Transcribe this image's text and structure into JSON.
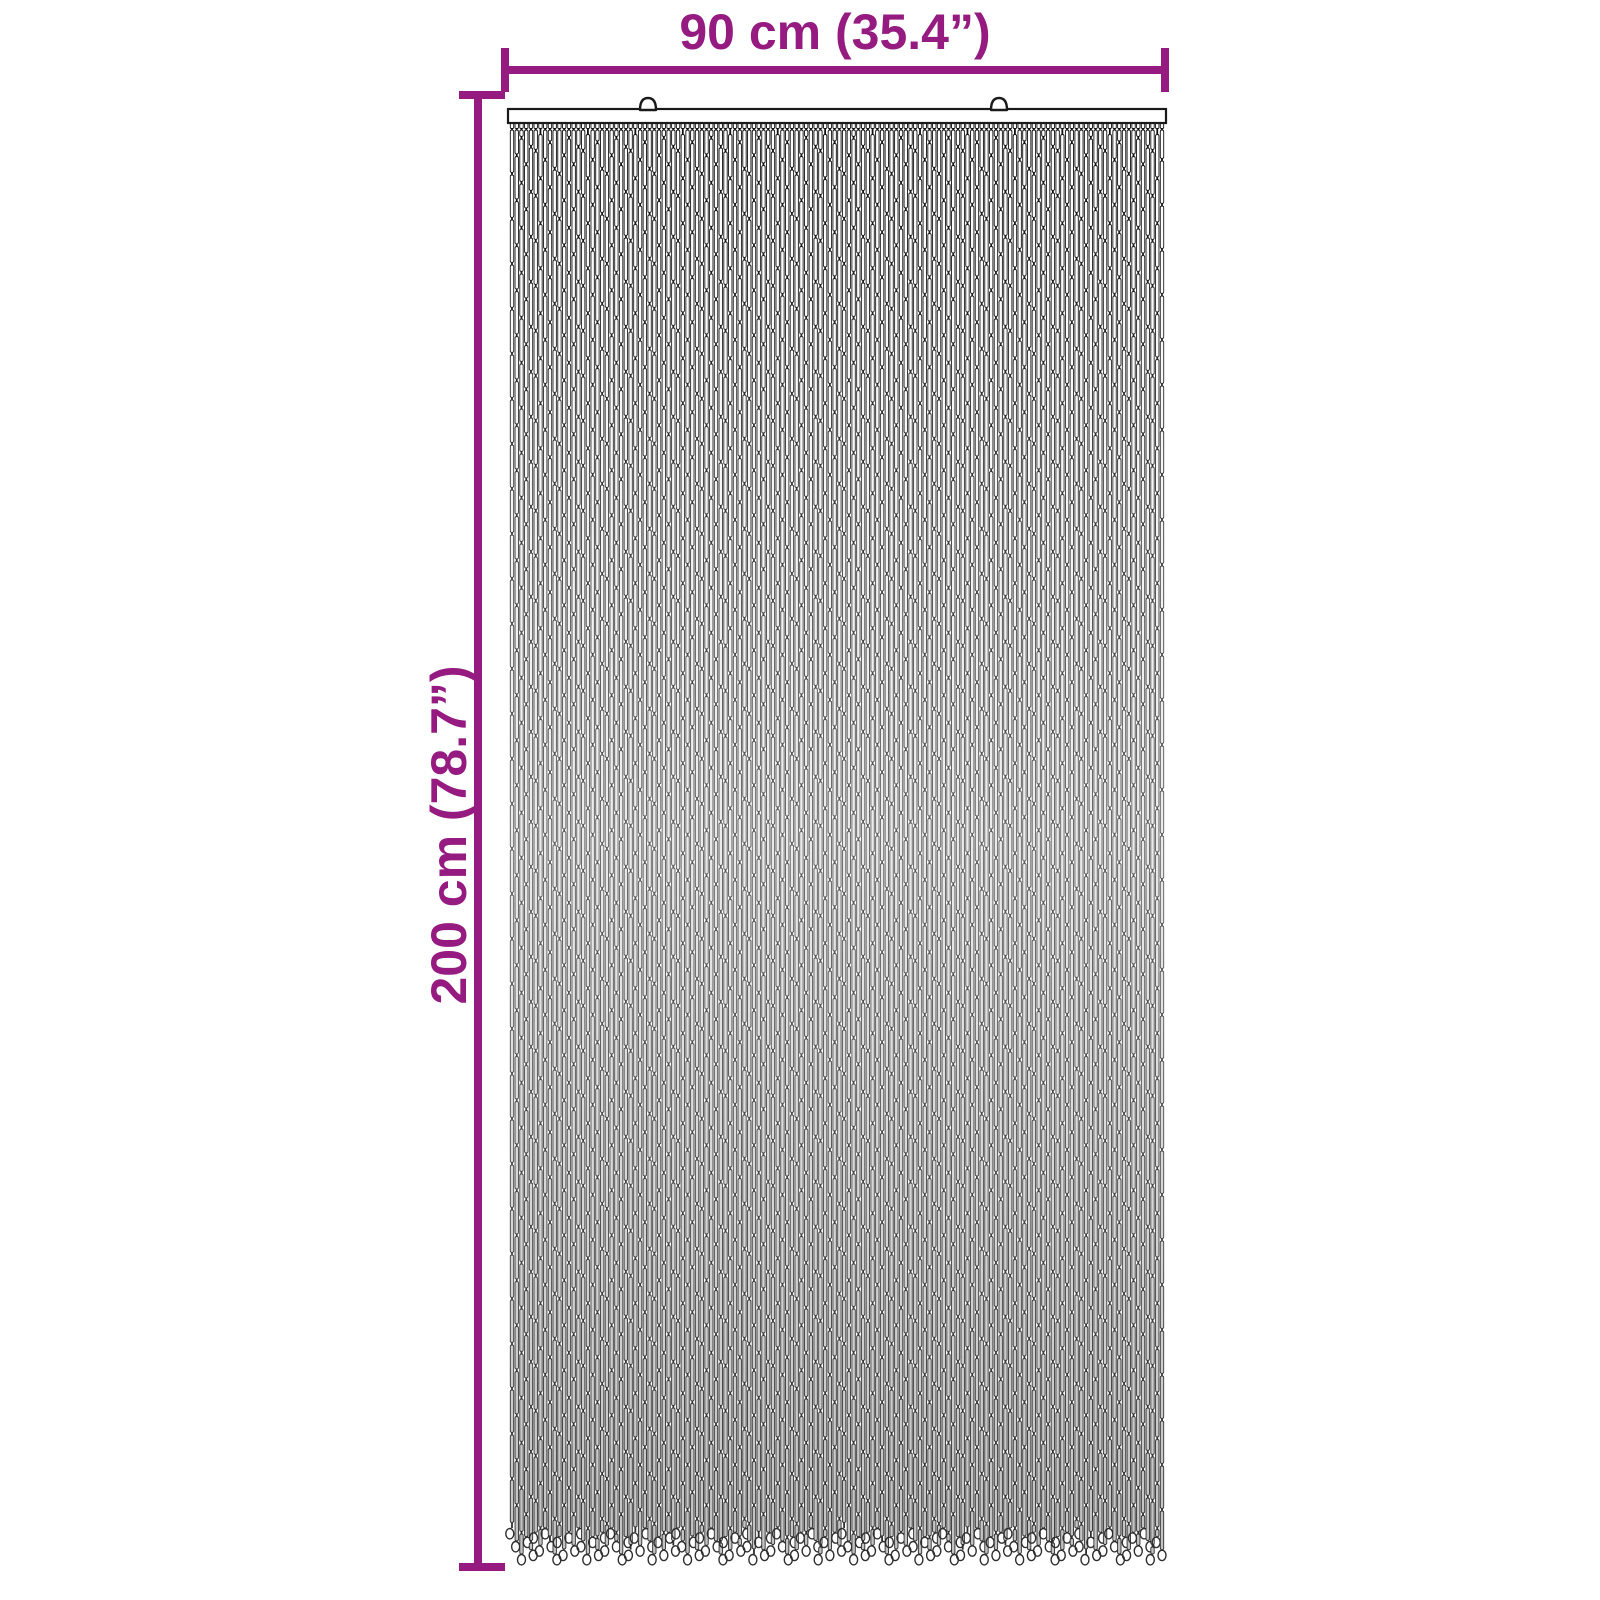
{
  "page": {
    "background": "#ffffff"
  },
  "dimensions": {
    "width_label": "90 cm (35.4”)",
    "height_label": "200 cm (78.7”)",
    "accent_color": "#951b81"
  },
  "curtain": {
    "rail": {
      "x": 508,
      "y": 109,
      "width": 658,
      "height": 14,
      "fill": "#ffffff",
      "stroke": "#1a1a1a"
    },
    "hooks": {
      "positions_x": [
        648,
        999
      ],
      "half_width": 8,
      "dome_height": 12,
      "stroke": "#1a1a1a",
      "fill": "#ffffff"
    },
    "strands": {
      "count": 138,
      "left": 512,
      "right": 1162,
      "top": 123,
      "bottom_min": 1528,
      "bottom_max": 1554,
      "segment_height": 42.5,
      "segment_gap": 2.5,
      "segment_width": 3.4,
      "nub_height": 5.5,
      "loop_rx": 4,
      "loop_ry": 5.2,
      "fill_stops": [
        "#ffffff",
        "#ececec",
        "#c2c2c2"
      ],
      "stroke_stops": [
        "#0f0f0f",
        "#606060",
        "#2d2d2d"
      ]
    }
  }
}
